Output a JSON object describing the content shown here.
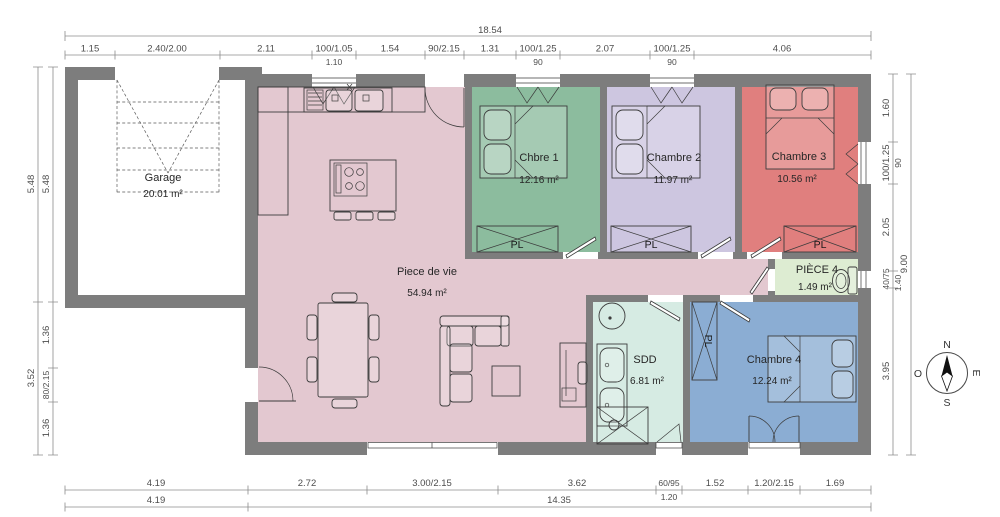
{
  "plan": {
    "rooms": {
      "garage": {
        "name": "Garage",
        "area": "20.01 m²"
      },
      "piece_de_vie": {
        "name": "Piece de vie",
        "area": "54.94 m²"
      },
      "chbre1": {
        "name": "Chbre 1",
        "area": "12.16 m²"
      },
      "chambre2": {
        "name": "Chambre 2",
        "area": "11.97 m²"
      },
      "chambre3": {
        "name": "Chambre 3",
        "area": "10.56 m²"
      },
      "piece4": {
        "name": "PIÈCE 4",
        "area": "1.49 m²"
      },
      "sdd": {
        "name": "SDD",
        "area": "6.81 m²"
      },
      "chambre4": {
        "name": "Chambre 4",
        "area": "12.24 m²"
      }
    },
    "closet_label": "PL",
    "compass": {
      "n": "N",
      "s": "S",
      "o": "O",
      "e": "E"
    }
  },
  "dims": {
    "top_total": "18.54",
    "top": [
      "1.15",
      "2.40/2.00",
      "2.11",
      "100/1.05",
      "1.54",
      "90/2.15",
      "1.31",
      "100/1.25",
      "2.07",
      "100/1.25",
      "4.06"
    ],
    "top_sub": [
      "1.10",
      "90",
      "90"
    ],
    "left_outer": [
      "5.48",
      "3.52"
    ],
    "left_inner": [
      "5.48",
      "1.36",
      "80/2.15",
      "1.36"
    ],
    "right_inner": [
      "1.60",
      "100/1.25",
      "2.05",
      "40/75",
      "3.95"
    ],
    "right_sub": [
      "90",
      "1.40"
    ],
    "right_total": "9.00",
    "bottom": [
      "4.19",
      "2.72",
      "3.00/2.15",
      "3.62",
      "60/95",
      "1.52",
      "1.20/2.15",
      "1.69"
    ],
    "bottom_sub": [
      "1.20"
    ],
    "bottom_totals": [
      "4.19",
      "14.35"
    ]
  },
  "colors": {
    "wall": "#7D7D7D",
    "piece_de_vie": "#E3C8D0",
    "chbre1": "#8CBC9E",
    "chambre2": "#CDC6E0",
    "chambre3": "#E07F7E",
    "piece4": "#DDECD2",
    "sdd": "#D6EBE3",
    "chambre4": "#8BADD3",
    "garage_floor": "#FFFFFF",
    "dim_text": "#4D4D4D"
  }
}
